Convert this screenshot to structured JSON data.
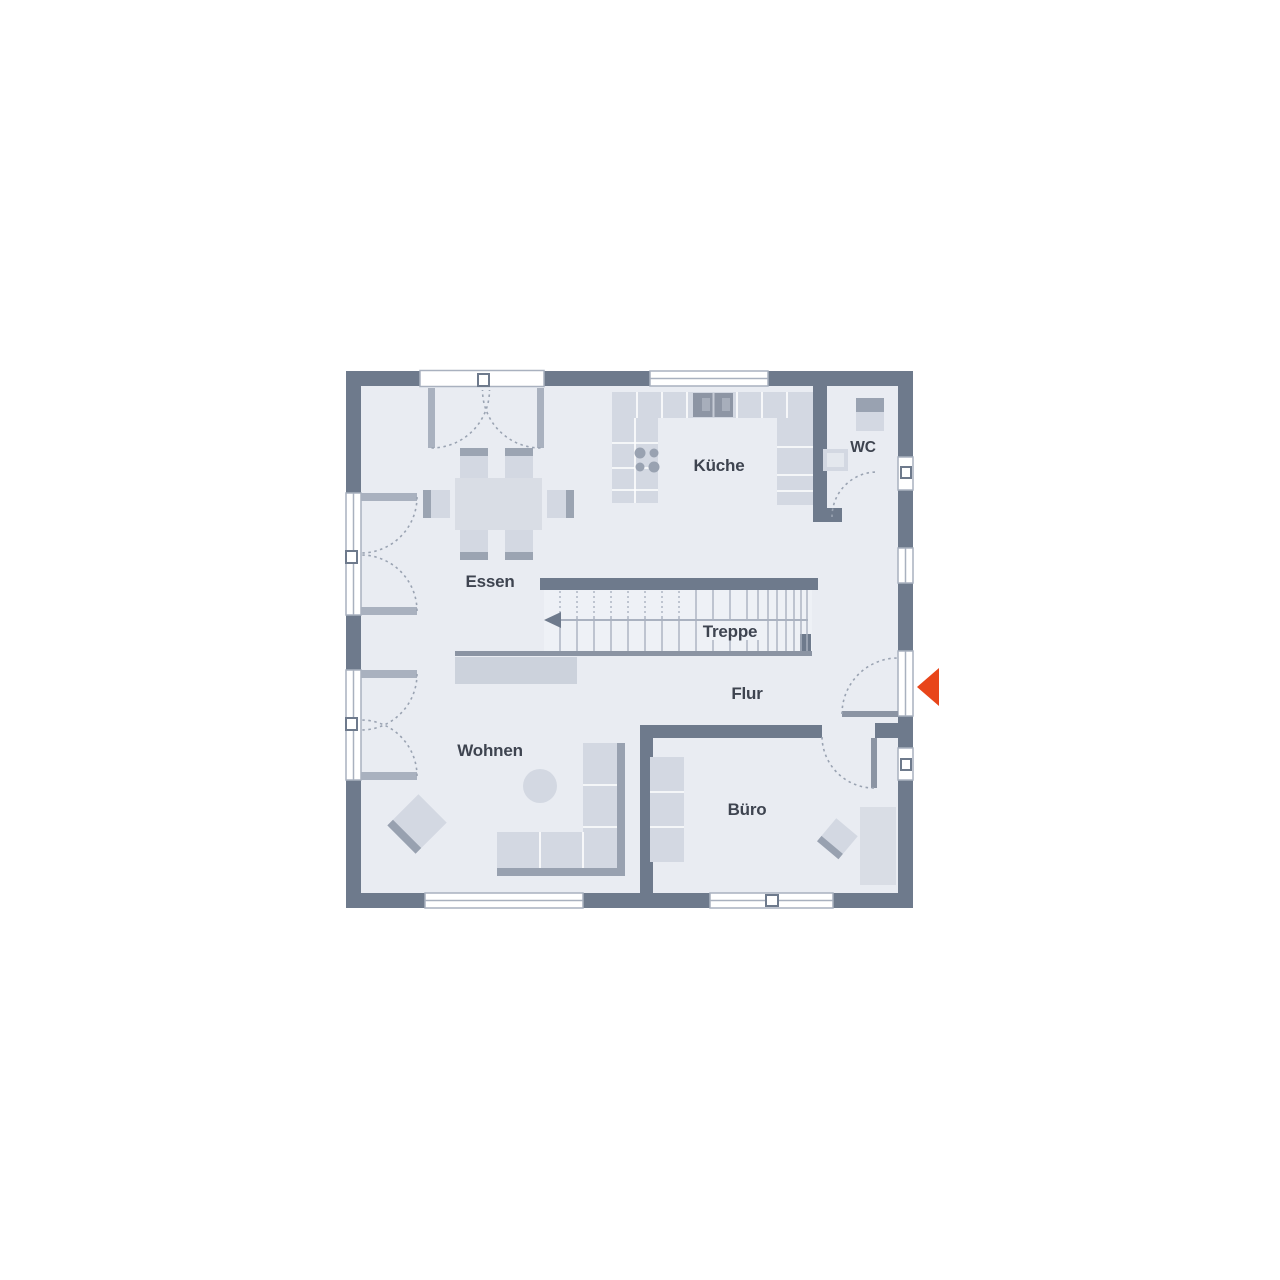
{
  "plan": {
    "type": "floor-plan",
    "rooms": [
      {
        "id": "essen",
        "label": "Essen"
      },
      {
        "id": "kueche",
        "label": "Küche"
      },
      {
        "id": "wc",
        "label": "WC"
      },
      {
        "id": "treppe",
        "label": "Treppe"
      },
      {
        "id": "flur",
        "label": "Flur"
      },
      {
        "id": "wohnen",
        "label": "Wohnen"
      },
      {
        "id": "buero",
        "label": "Büro"
      }
    ],
    "entrance": {
      "marker": "arrow-left",
      "color": "#e8451a"
    },
    "stair": {
      "direction_line": "arrow-left"
    },
    "colors": {
      "background": "#ffffff",
      "wall": "#6e7a8c",
      "floor": "#e9ecf2",
      "stair_floor": "#eef1f6",
      "furniture": "#d3d8e2",
      "furniture_dark": "#9ba4b2",
      "fixture_dark": "#8d95a4",
      "outline": "#9aa3b2",
      "text": "#3e4450"
    }
  }
}
